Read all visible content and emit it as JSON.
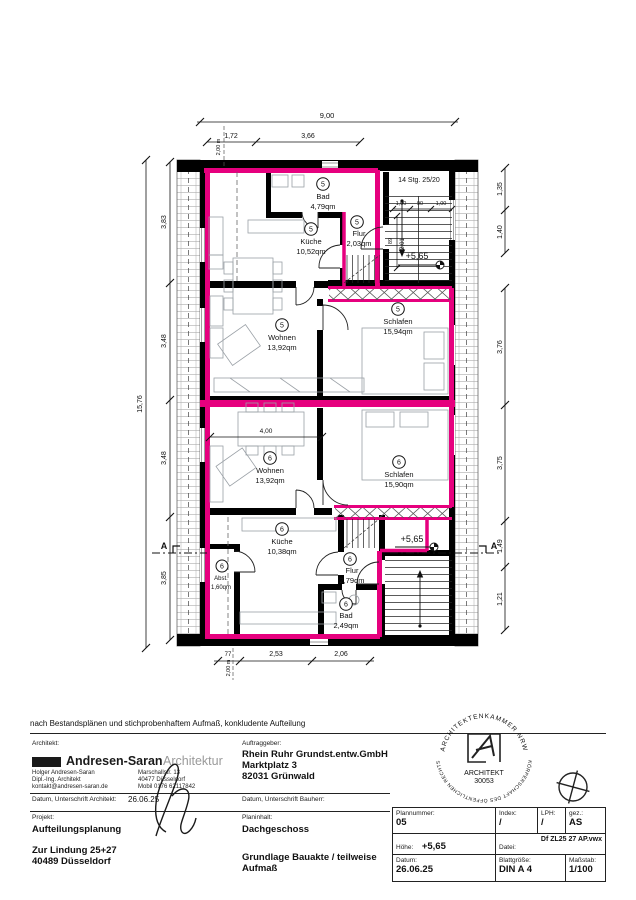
{
  "plan": {
    "dims": {
      "top_total": "9,00",
      "top_segs": [
        "1,72",
        "3,66"
      ],
      "left_total": "15,76",
      "left_segs": [
        "3,83",
        "3,48",
        "3,48",
        "3,85"
      ],
      "right_segs": [
        "1,35",
        "1,40",
        "3,76",
        "3,75",
        "1,49",
        "1,21"
      ],
      "bottom_segs": [
        "77",
        "2,53",
        "2,06"
      ],
      "headroom": "2,00 m",
      "stair_dims": [
        "1,00",
        "90",
        "1,00"
      ],
      "stair_vdims": [
        "89",
        "2,01"
      ],
      "wohnen6_width": "4,00"
    },
    "labels": {
      "stairs": "14 Stg. 25/20",
      "level": "+5,65",
      "section": "A"
    },
    "rooms": [
      {
        "unit": "5",
        "name": "Bad",
        "area": "4,79qm"
      },
      {
        "unit": "5",
        "name": "Küche",
        "area": "10,52qm"
      },
      {
        "unit": "5",
        "name": "Flur",
        "area": "2,03qm"
      },
      {
        "unit": "5",
        "name": "Wohnen",
        "area": "13,92qm"
      },
      {
        "unit": "5",
        "name": "Schlafen",
        "area": "15,94qm"
      },
      {
        "unit": "6",
        "name": "Wohnen",
        "area": "13,92qm"
      },
      {
        "unit": "6",
        "name": "Schlafen",
        "area": "15,90qm"
      },
      {
        "unit": "6",
        "name": "Küche",
        "area": "10,38qm"
      },
      {
        "unit": "6",
        "name": "Flur",
        "area": "2,79qm"
      },
      {
        "unit": "6",
        "name": "Abst.",
        "area": "1,60qm"
      },
      {
        "unit": "6",
        "name": "Bad",
        "area": "2,49qm"
      }
    ],
    "colors": {
      "unit_outline": "#e6007e",
      "wall": "#000000"
    }
  },
  "titleblock": {
    "disclaimer": "nach Bestandsplänen und stichprobenhaftem Aufmaß, konkludente Aufteilung",
    "architect": {
      "label": "Architekt:",
      "firm_bold": "Andresen-Saran",
      "firm_light": "Architektur",
      "name": "Holger Andresen-Saran",
      "title": "Dipl.-Ing. Architekt",
      "email": "kontakt@andresen-saran.de",
      "street": "Marschallstr. 13",
      "city": "40477 Düsseldorf",
      "mobile": "Mobil 0176 62117842",
      "date_label": "Datum, Unterschrift Architekt:",
      "date_value": "26.06.25"
    },
    "client": {
      "label": "Auftraggeber:",
      "name": "Rhein Ruhr Grundst.entw.GmbH",
      "street": "Marktplatz 3",
      "city": "82031 Grünwald",
      "date_label": "Datum, Unterschrift Bauherr:"
    },
    "project": {
      "label": "Projekt:",
      "name": "Aufteilungsplanung",
      "street": "Zur Lindung 25+27",
      "city": "40489 Düsseldorf"
    },
    "content": {
      "label": "Planinhalt:",
      "name": "Dachgeschoss",
      "basis": "Grundlage Bauakte / teilweise Aufmaß"
    },
    "stamp": {
      "arc_top": "ARCHITEKTENKAMMER NRW",
      "arc_bottom": "KÖRPERSCHAFT DES ÖFFENTLICHEN RECHTS",
      "center1": "ARCHITEKT",
      "center2": "30053"
    },
    "grid": {
      "plannummer_label": "Plannummer:",
      "plannummer": "05",
      "index_label": "Index:",
      "index": "/",
      "lph_label": "LPH:",
      "lph": "/",
      "gez_label": "gez.:",
      "gez": "AS",
      "hoehe_label": "Höhe:",
      "hoehe": "+5,65",
      "datei_label": "Datei:",
      "datei": "Df ZL25 27 AP.vwx",
      "datum_label": "Datum:",
      "datum": "26.06.25",
      "blatt_label": "Blattgröße:",
      "blatt": "DIN A 4",
      "massstab_label": "Maßstab:",
      "massstab": "1/100"
    }
  }
}
